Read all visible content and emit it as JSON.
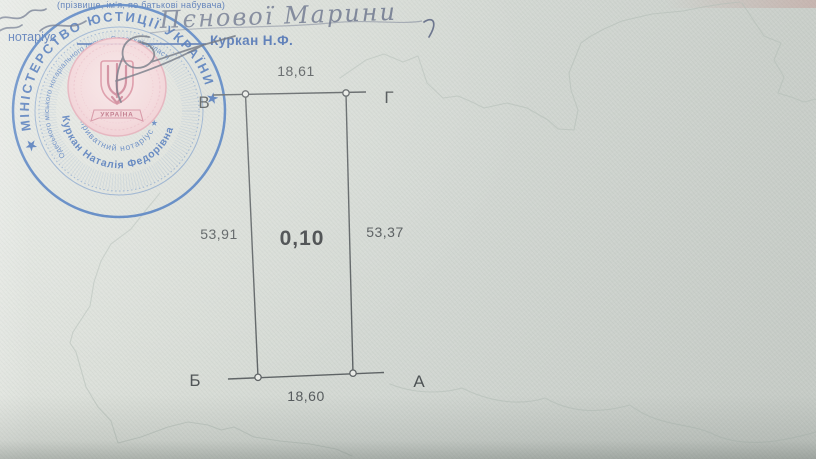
{
  "document": {
    "field_caption": "(прізвище, ім'я, по батькові набувача)",
    "handwritten_name": "Пєнової Марини",
    "notary_line_label": "нотаріус",
    "notary_name": "Куркан Н.Ф."
  },
  "plot_diagram": {
    "area_value": "0,10",
    "side_top": "18,61",
    "side_left": "53,91",
    "side_right": "53,37",
    "side_bottom": "18,60",
    "corner_top_left": "В",
    "corner_top_right": "Г",
    "corner_bottom_left": "Б",
    "corner_bottom_right": "А"
  },
  "stamp": {
    "outer_ring_text": "★ МІНІСТЕРСТВО ЮСТИЦІЇ УКРАЇНИ ★",
    "middle_ring_text": "Одеського міського нотаріального округу Одеської області",
    "title_arc_text": "приватний нотаріус ★",
    "name_arc_text": "Куркан Наталія Федорівна",
    "emblem_banner_text": "УКРАЇНА",
    "colors": {
      "ink_blue": "#4576bd",
      "emblem_pink": "#d98ba0"
    }
  },
  "page_colors": {
    "paper_light": "#e5e8e3",
    "paper_dark": "#c5cac5",
    "line_gray": "#5e6365"
  }
}
